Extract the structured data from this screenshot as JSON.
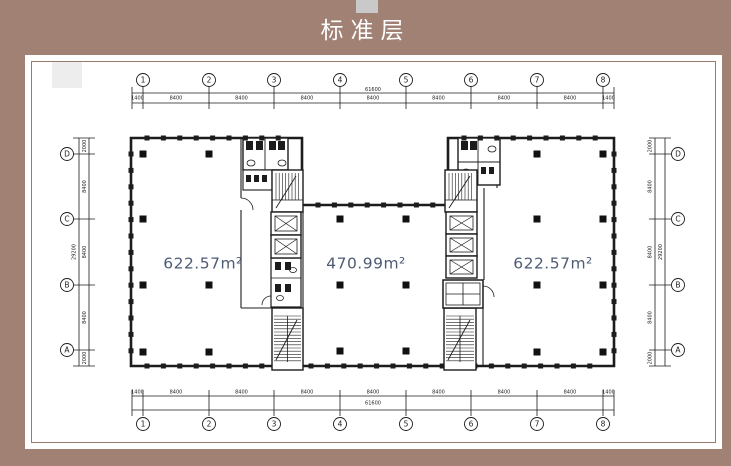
{
  "title_bar": {
    "title": "标准层"
  },
  "plan": {
    "area_labels": [
      {
        "text": "622.57m²"
      },
      {
        "text": "470.99m²"
      },
      {
        "text": "622.57m²"
      }
    ],
    "axes": {
      "top_bubbles": [
        "1",
        "2",
        "3",
        "4",
        "5",
        "6",
        "7",
        "8"
      ],
      "bottom_bubbles": [
        "1",
        "2",
        "3",
        "4",
        "5",
        "6",
        "7",
        "8"
      ],
      "left_bubbles": [
        "D",
        "C",
        "B",
        "A"
      ],
      "right_bubbles": [
        "D",
        "C",
        "B",
        "A"
      ],
      "h_segments": [
        "1400",
        "8400",
        "8400",
        "8400",
        "8400",
        "8400",
        "8400",
        "8400",
        "1400"
      ],
      "h_total": "61600",
      "v_segments": [
        "2000",
        "8400",
        "8400",
        "8400",
        "2000"
      ],
      "v_total": "29200"
    },
    "colors": {
      "background": "#a08174",
      "tab": "#c9c9c9",
      "panel_border": "#9a7a6d",
      "line": "#1c1c1c",
      "dim_text": "#222222",
      "area_text": "#4e5b74"
    }
  }
}
